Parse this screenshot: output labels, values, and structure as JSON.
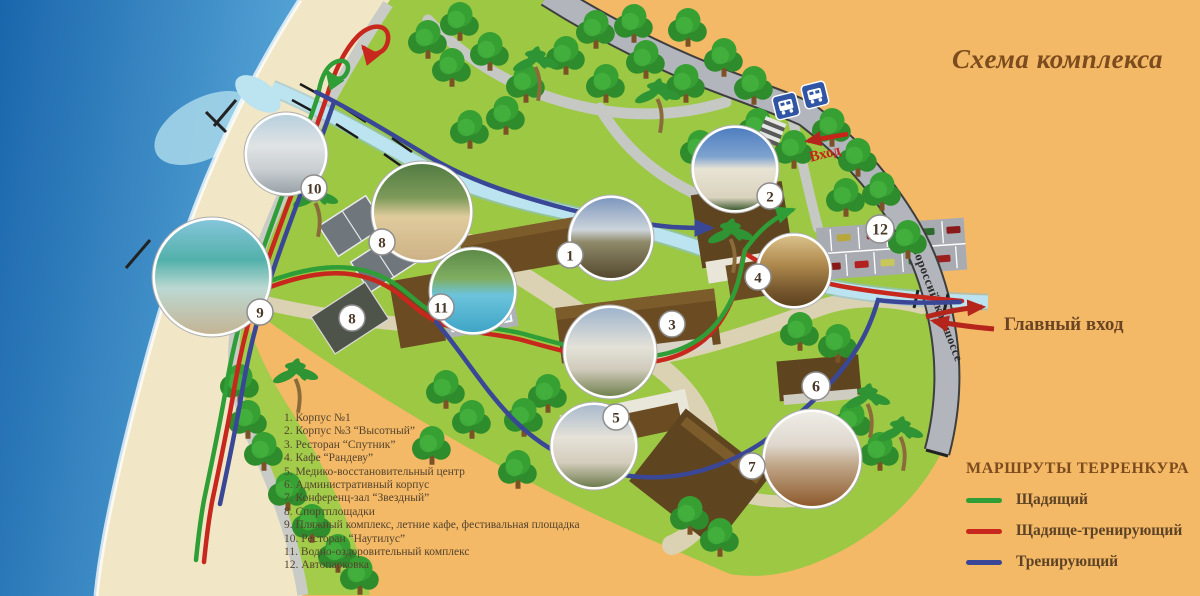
{
  "title": "Схема комплекса",
  "labels": {
    "entrance": "Вход",
    "main_entrance": "Главный вход",
    "highway": "Новороссийское шоссе"
  },
  "legend": {
    "items": [
      "1. Корпус №1",
      "2. Корпус №3 “Высотный”",
      "3. Ресторан “Спутник”",
      "4. Кафе “Рандеву”",
      "5. Медико-восстановительный центр",
      "6. Административный корпус",
      "7. Конференц-зал “Звездный”",
      "8. Спортплощадки",
      "9. Пляжный комплекс, летние кафе, фестивальная площадка",
      "10. Ресторан “Наутилус”",
      "11. Водно-оздоровительный комплекс",
      "12. Автопарковка"
    ]
  },
  "routes_legend": {
    "title": "МАРШРУТЫ ТЕРРЕНКУРА",
    "items": [
      {
        "label": "Щадящий",
        "color": "#2f9e36"
      },
      {
        "label": "Щадяще-тренирующий",
        "color": "#c7271d"
      },
      {
        "label": "Тренирующий",
        "color": "#3a4796"
      }
    ]
  },
  "colors": {
    "background": "#f3b966",
    "sea": "#1a66ac",
    "sand": "#f1e7c6",
    "grass": "#9cc844",
    "road": "#b2b6bc",
    "river": "#bce4f0",
    "route_green": "#2f9e36",
    "route_red": "#c7271d",
    "route_blue": "#3a4796",
    "entrance_red": "#b5251c"
  },
  "map": {
    "markers": [
      {
        "number": "1",
        "kind": "photo",
        "photo": "building1",
        "x": 611,
        "y": 238,
        "r": 40,
        "bx": 570,
        "by": 255
      },
      {
        "number": "2",
        "kind": "photo",
        "photo": "tower",
        "x": 735,
        "y": 169,
        "r": 41,
        "bx": 770,
        "by": 196
      },
      {
        "number": "3",
        "kind": "photo",
        "photo": "restaurant",
        "x": 610,
        "y": 352,
        "r": 44,
        "bx": 672,
        "by": 324
      },
      {
        "number": "4",
        "kind": "photo",
        "photo": "cafe",
        "x": 794,
        "y": 271,
        "r": 35,
        "bx": 758,
        "by": 277
      },
      {
        "number": "5",
        "kind": "photo",
        "photo": "medcenter",
        "x": 594,
        "y": 446,
        "r": 41,
        "bx": 616,
        "by": 417
      },
      {
        "number": "6",
        "kind": "badge",
        "x": 816,
        "y": 386,
        "r": 14
      },
      {
        "number": "7",
        "kind": "photo",
        "photo": "hall",
        "x": 812,
        "y": 459,
        "r": 47,
        "bx": 752,
        "by": 466
      },
      {
        "number": "8",
        "kind": "photo",
        "photo": "volleyball",
        "x": 422,
        "y": 212,
        "r": 48,
        "bx": 382,
        "by": 242
      },
      {
        "number": "8",
        "kind": "badge",
        "x": 352,
        "y": 318,
        "r": 13
      },
      {
        "number": "9",
        "kind": "photo",
        "photo": "beach",
        "x": 212,
        "y": 277,
        "r": 57,
        "bx": 260,
        "by": 312
      },
      {
        "number": "10",
        "kind": "photo",
        "photo": "terrace",
        "x": 286,
        "y": 154,
        "r": 39,
        "bx": 314,
        "by": 188
      },
      {
        "number": "11",
        "kind": "photo",
        "photo": "pool",
        "x": 473,
        "y": 291,
        "r": 41,
        "bx": 441,
        "by": 307
      },
      {
        "number": "12",
        "kind": "badge",
        "x": 880,
        "y": 229,
        "r": 14
      }
    ]
  }
}
